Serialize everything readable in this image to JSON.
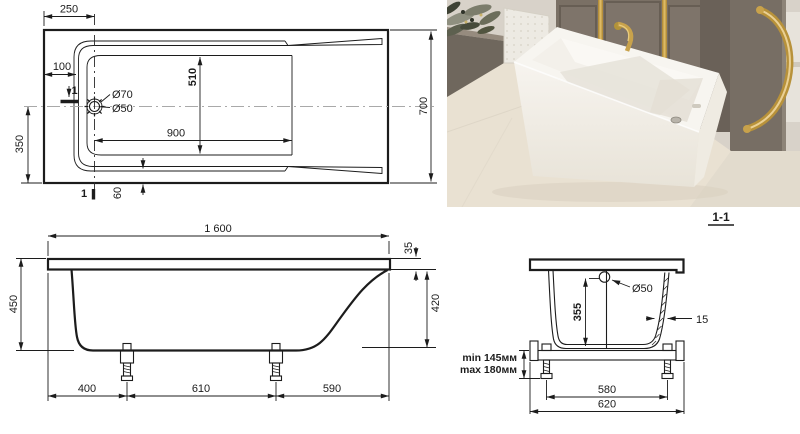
{
  "drawing_title": "bathtub technical drawing",
  "top_view": {
    "section_marker": "1",
    "dims": {
      "d250": "250",
      "d100": "100",
      "d70": "Ø70",
      "d50": "Ø50",
      "d510": "510",
      "d900": "900",
      "d350": "350",
      "d60": "60",
      "d700": "700"
    }
  },
  "side_view": {
    "dims": {
      "d1600": "1 600",
      "d35": "35",
      "d450": "450",
      "d420": "420",
      "d400": "400",
      "d610": "610",
      "d590": "590"
    }
  },
  "section_view": {
    "label": "1-1",
    "dims": {
      "d50": "Ø50",
      "d355": "355",
      "d15": "15",
      "min": "min 145мм",
      "max": "max 180мм",
      "d580": "580",
      "d620": "620"
    }
  },
  "colors": {
    "line": "#1c1c1c",
    "centerline": "#a9a9a9",
    "gold_accent": "#c8a24b",
    "wall_grey": "#7a7065",
    "floor_cream": "#e9e1d2",
    "tub_white": "#f7f5f0"
  }
}
